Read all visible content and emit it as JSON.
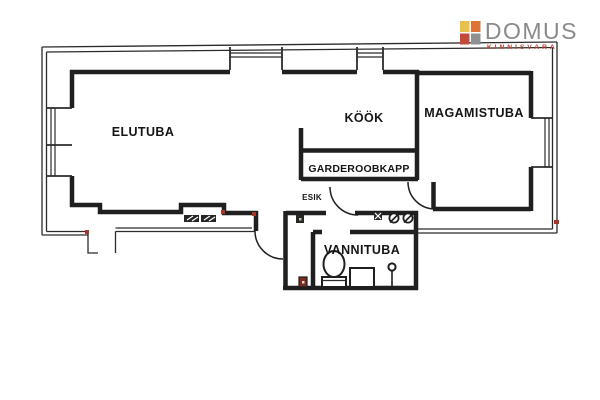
{
  "brand": {
    "name": "DOMUS",
    "tagline": "KINNISVARA",
    "colors": {
      "square_top_left": "#e6c14b",
      "square_top_right": "#dd7436",
      "square_bottom_left": "#c3493a",
      "square_bottom_right": "#8f9091",
      "name_text": "#8a8a8a",
      "tagline_text": "#b8473a"
    }
  },
  "plan": {
    "wall_color": "#1f1f1f",
    "accent_mark_color": "#a8362b",
    "rooms": [
      {
        "id": "elutuba",
        "label": "ELUTUBA"
      },
      {
        "id": "kook",
        "label": "KÖÖK"
      },
      {
        "id": "magamistuba",
        "label": "MAGAMISTUBA"
      },
      {
        "id": "garderoobkapp",
        "label": "GARDEROOBKAPP"
      },
      {
        "id": "esik",
        "label": "ESIK"
      },
      {
        "id": "vannituba",
        "label": "VANNITUBA"
      }
    ]
  }
}
